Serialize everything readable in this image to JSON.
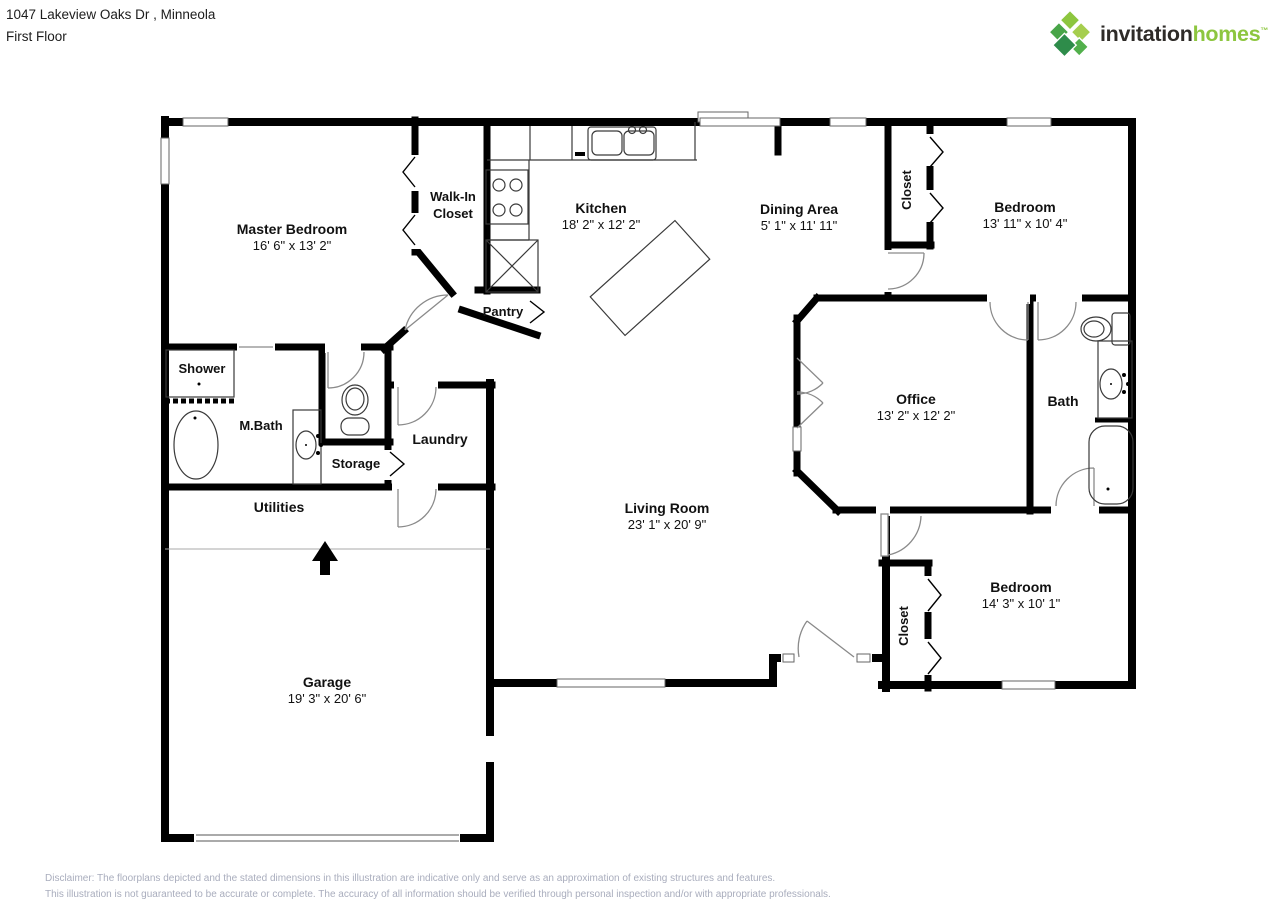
{
  "header": {
    "address": "1047 Lakeview Oaks Dr , Minneola",
    "floor": "First Floor"
  },
  "logo": {
    "word1": "invitation",
    "word2": "homes",
    "tm": "™"
  },
  "colors": {
    "wall": "#000000",
    "door_arc": "#8a8a8a",
    "fixture": "#3a3a3a",
    "logo_green": "#8dc63f",
    "logo_dark": "#2e2b28",
    "disclaimer_text": "#a9adbd"
  },
  "rooms": [
    {
      "id": "master-bedroom",
      "name": "Master Bedroom",
      "dims": "16' 6\" x 13' 2\""
    },
    {
      "id": "walk-in-closet",
      "name": "Walk-In Closet",
      "line1": "Walk-In",
      "line2": "Closet"
    },
    {
      "id": "kitchen",
      "name": "Kitchen",
      "dims": "18' 2\" x 12' 2\""
    },
    {
      "id": "dining-area",
      "name": "Dining Area",
      "dims": "5' 1\" x 11' 11\""
    },
    {
      "id": "closet-top",
      "name": "Closet"
    },
    {
      "id": "bedroom-top",
      "name": "Bedroom",
      "dims": "13' 11\" x 10' 4\""
    },
    {
      "id": "pantry",
      "name": "Pantry"
    },
    {
      "id": "shower",
      "name": "Shower"
    },
    {
      "id": "m-bath",
      "name": "M.Bath"
    },
    {
      "id": "storage",
      "name": "Storage"
    },
    {
      "id": "laundry",
      "name": "Laundry"
    },
    {
      "id": "office",
      "name": "Office",
      "dims": "13' 2\" x 12' 2\""
    },
    {
      "id": "bath",
      "name": "Bath"
    },
    {
      "id": "utilities",
      "name": "Utilities"
    },
    {
      "id": "living-room",
      "name": "Living Room",
      "dims": "23' 1\" x 20' 9\""
    },
    {
      "id": "closet-bottom",
      "name": "Closet"
    },
    {
      "id": "bedroom-bottom",
      "name": "Bedroom",
      "dims": "14' 3\" x 10' 1\""
    },
    {
      "id": "garage",
      "name": "Garage",
      "dims": "19' 3\" x 20' 6\""
    }
  ],
  "footer": {
    "line1": "Disclaimer: The floorplans depicted and the stated dimensions in this illustration are indicative only and serve as an approximation of existing structures and features.",
    "line2": "This illustration is not guaranteed to be accurate or complete. The accuracy of all information should be verified through personal inspection and/or with appropriate professionals."
  }
}
